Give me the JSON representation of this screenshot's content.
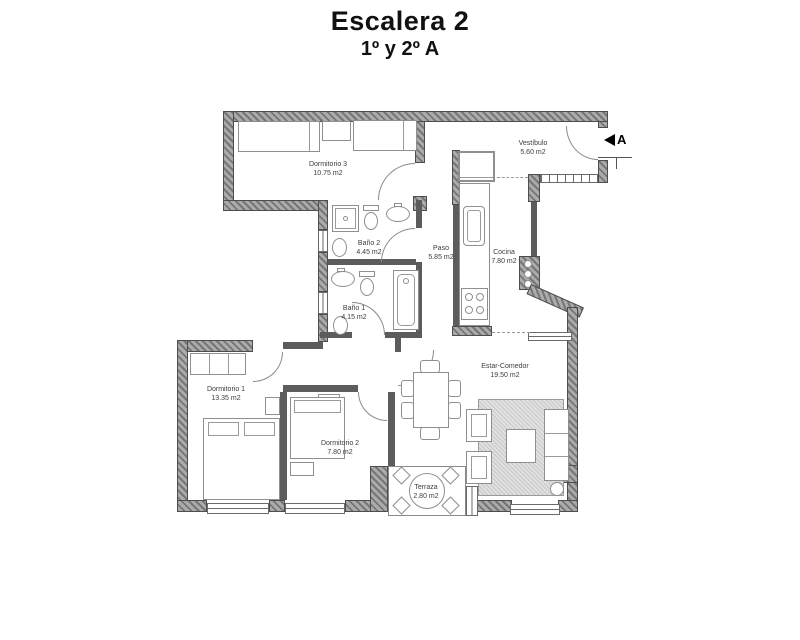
{
  "header": {
    "title": "Escalera 2",
    "subtitle": "1º y 2º A"
  },
  "plan": {
    "marker": {
      "label": "A"
    },
    "rooms": {
      "dormitorio3": {
        "name": "Dormitorio 3",
        "area": "10.75 m2"
      },
      "vestibulo": {
        "name": "Vestíbulo",
        "area": "5.60 m2"
      },
      "bano2": {
        "name": "Baño 2",
        "area": "4.45 m2"
      },
      "paso": {
        "name": "Paso",
        "area": "5.85 m2"
      },
      "cocina": {
        "name": "Cocina",
        "area": "7.80 m2"
      },
      "bano1": {
        "name": "Baño 1",
        "area": "4.15 m2"
      },
      "dormitorio1": {
        "name": "Dormitorio 1",
        "area": "13.35 m2"
      },
      "dormitorio2": {
        "name": "Dormitorio 2",
        "area": "7.80 m2"
      },
      "estar": {
        "name": "Estar-Comedor",
        "area": "19.50 m2"
      },
      "terraza": {
        "name": "Terraza",
        "area": "2.80 m2"
      }
    },
    "colors": {
      "wall": "#767676",
      "line": "#8f8f8f",
      "text": "#3c3c3c"
    }
  }
}
